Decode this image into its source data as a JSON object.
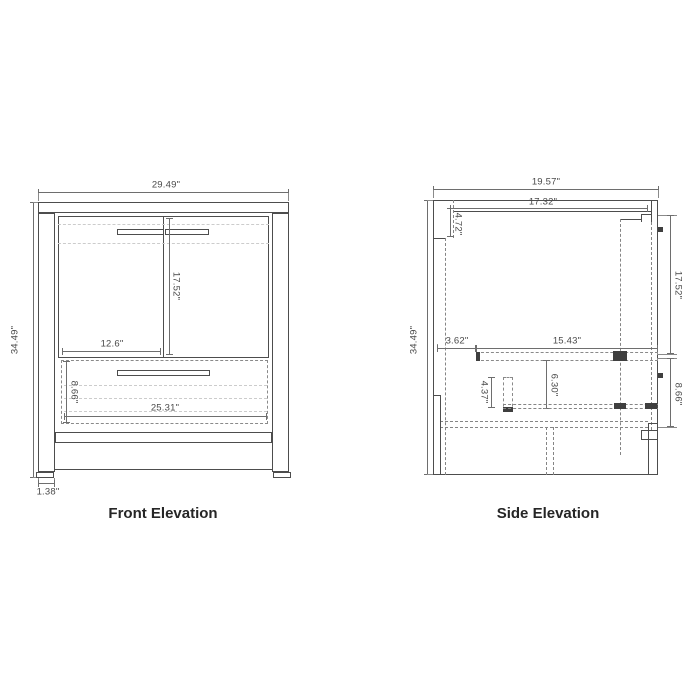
{
  "front_elevation": {
    "label": "Front Elevation",
    "dims": {
      "overall_width": "29.49\"",
      "overall_height": "34.49\"",
      "door_height": "17.52\"",
      "left_door_width": "12.6\"",
      "drawer_height": "8.66\"",
      "drawer_width": "25.31\"",
      "leg_width": "1.38\""
    }
  },
  "side_elevation": {
    "label": "Side Elevation",
    "dims": {
      "overall_depth": "19.57\"",
      "top_inner_depth": "17.32\"",
      "backsplash_height": "4.72\"",
      "overall_height": "34.49\"",
      "door_height": "17.52\"",
      "back_offset": "3.62\"",
      "glide_length": "15.43\"",
      "drawer_height": "8.66\"",
      "bracket_height": "4.37\"",
      "drawer_depth": "6.30\""
    }
  },
  "colors": {
    "background": "#ffffff",
    "outline": "#4d4d4d",
    "hidden_line": "#858585",
    "faint_line": "#cccccc",
    "dimension": "#6e6e6e",
    "label_text": "#262626"
  }
}
